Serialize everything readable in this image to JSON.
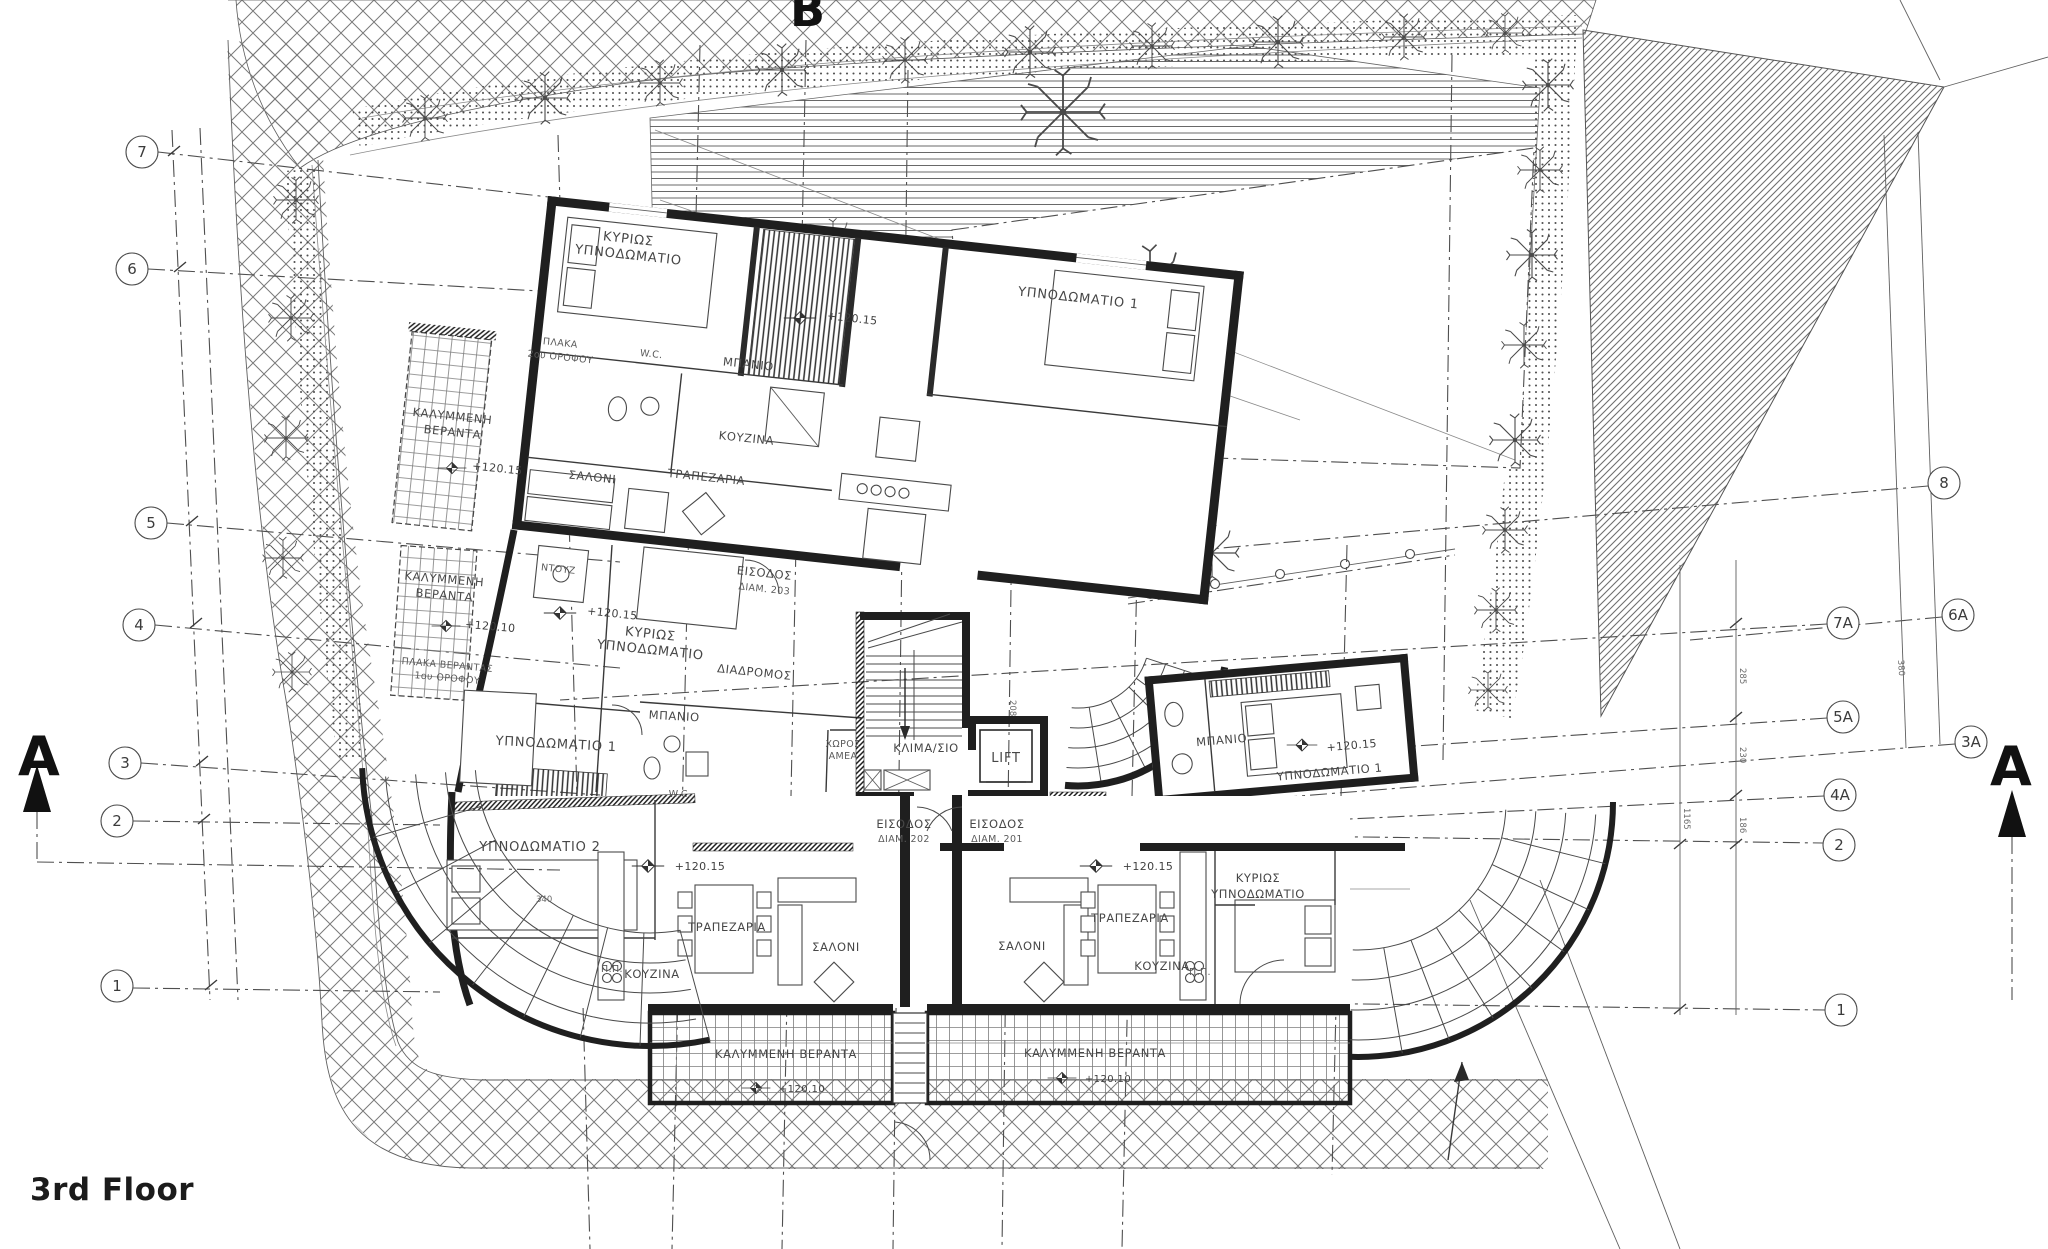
{
  "title": "3rd Floor",
  "markers": {
    "section_a": "A",
    "section_b": "B"
  },
  "grid_bubbles": {
    "left": [
      "7",
      "6",
      "5",
      "4",
      "3",
      "2",
      "1"
    ],
    "right": [
      "8",
      "7A",
      "6A",
      "5A",
      "3A",
      "4A",
      "2",
      "1"
    ]
  },
  "levels": {
    "floor": "+120.15",
    "veranda": "+120.10"
  },
  "rooms": {
    "master_l1": "ΚΥΡΙΩΣ",
    "master_l2": "ΥΠΝΟΔΩΜΑΤΙΟ",
    "bedroom1": "ΥΠΝΟΔΩΜΑΤΙΟ 1",
    "bedroom2": "ΥΠΝΟΔΩΜΑΤΙΟ 2",
    "bathroom": "ΜΠΑΝΙΟ",
    "wc": "W.C.",
    "shower": "ΝΤΟΥΖ",
    "kitchen": "ΚΟΥΖΙΝΑ",
    "dining": "ΤΡΑΠΕΖΑΡΙΑ",
    "living": "ΣΑΛΟΝΙ",
    "corridor": "ΔΙΑΔΡΟΜΟΣ",
    "stairwell": "ΚΛΙΜΑ/ΣΙΟ",
    "lift": "LIFT",
    "disabled_l1": "ΧΩΡΟΣ",
    "disabled_l2": "ΑΜΕΑ",
    "veranda_l1": "ΚΑΛΥΜΜΕΝΗ",
    "veranda_l2": "ΒΕΡΑΝΤΑ",
    "veranda_full": "ΚΑΛΥΜΜΕΝΗ ΒΕΡΑΝΤΑ",
    "slab_l1": "ΠΛΑΚΑ",
    "slab_l2": "2ου ΟΡΟΦΟΥ",
    "slab_ver_l1": "ΠΛΑΚΑ ΒΕΡΑΝΤΑΣ",
    "slab_ver_l2": "1ου ΟΡΟΦΟΥ",
    "pp": "Π.Π."
  },
  "entrances": {
    "word": "ΕΙΣΟΔΟΣ",
    "apt203": "ΔΙΑΜ. 203",
    "apt202": "ΔΙΑΜ. 202",
    "apt201": "ΔΙΑΜ. 201"
  },
  "dimensions": {
    "d1165": "1165",
    "d285": "285",
    "d230": "230",
    "d186": "186",
    "d380": "380",
    "d340": "340",
    "d208": "208"
  },
  "colors": {
    "ink": "#1f1f1f",
    "line": "#4f4f4f",
    "hatch": "#6e6e6e"
  }
}
